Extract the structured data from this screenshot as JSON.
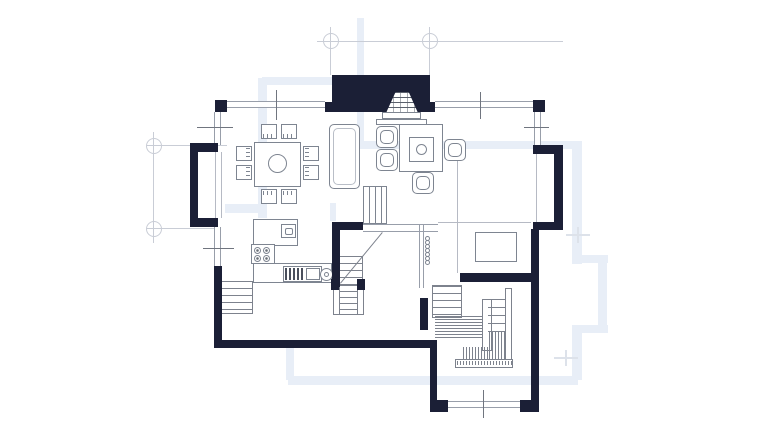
{
  "meta": {
    "drawing_type": "architectural-floor-plan",
    "visible_text": ""
  },
  "colors": {
    "background": "#ffffff",
    "wall": "#1b1f36",
    "window_line": "#989eaa",
    "furniture_line": "#7e8591",
    "stair_line": "#7d828d",
    "grid_line": "#c9cdd6",
    "underlay": "#e8eef7",
    "tick": "#70757f",
    "partition": "#b6bac4",
    "faint_cross": "#dde2ea"
  },
  "symbols": {
    "grid_markers": 4,
    "windows": 6,
    "window_break_ticks": 6,
    "fireplace": 1,
    "dining_table": 1,
    "dining_chairs": 8,
    "sofa": 1,
    "armchairs": 4,
    "coffee_table": 1,
    "cooktop_burners": 4,
    "kitchen_sink": 1,
    "oven_unit": 1,
    "staircases": 4,
    "balusters": 7,
    "cabinet_rect": 1
  },
  "balusters": {
    "count": 7,
    "x": 425,
    "y_start": 236,
    "step": 4,
    "size": 5
  }
}
